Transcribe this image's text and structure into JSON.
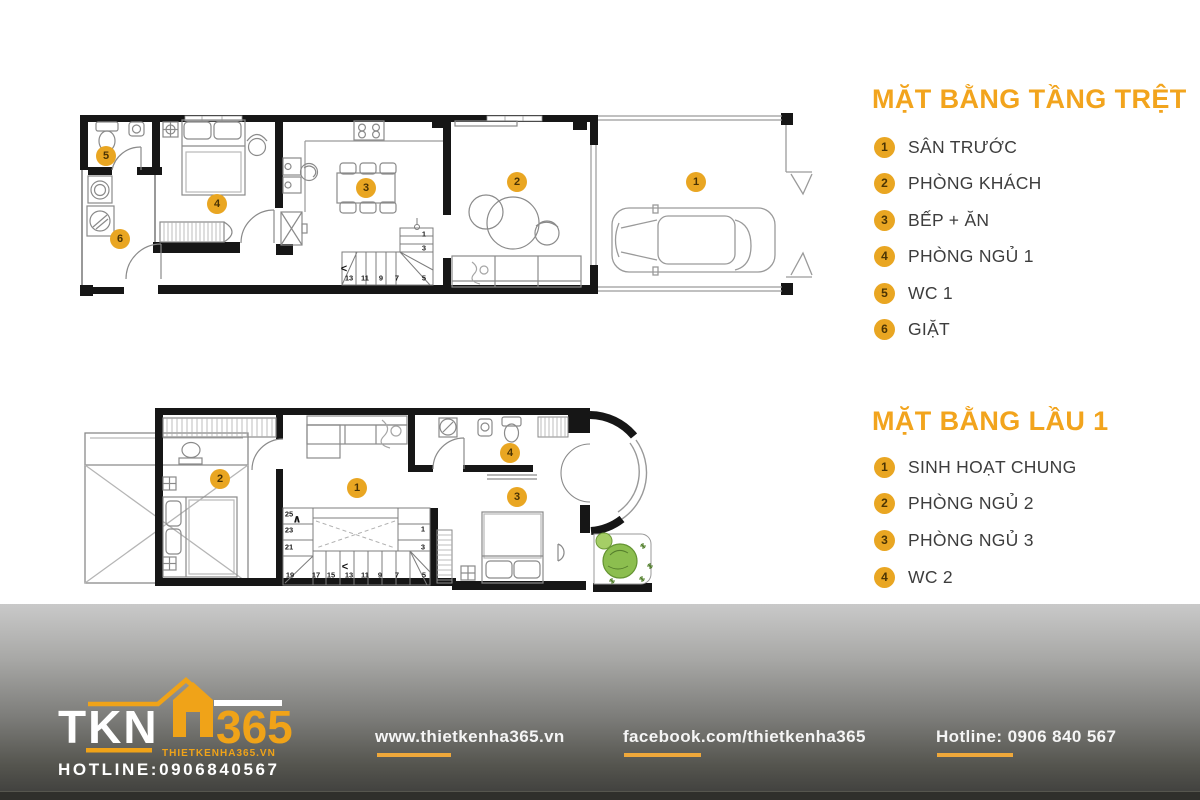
{
  "colors": {
    "accent": "#F0A41E",
    "marker_fill": "#E9A622",
    "legend_text": "#3D3D3D",
    "underline": "#EFA83A"
  },
  "ground_floor": {
    "title": "MẶT BẰNG TẦNG TRỆT",
    "items": [
      {
        "num": "1",
        "label": "SÂN TRƯỚC"
      },
      {
        "num": "2",
        "label": "PHÒNG KHÁCH"
      },
      {
        "num": "3",
        "label": "BẾP + ĂN"
      },
      {
        "num": "4",
        "label": "PHÒNG NGỦ 1"
      },
      {
        "num": "5",
        "label": "WC 1"
      },
      {
        "num": "6",
        "label": "GIẶT"
      }
    ],
    "markers": [
      {
        "n": "1",
        "x": 696,
        "y": 182
      },
      {
        "n": "2",
        "x": 517,
        "y": 182
      },
      {
        "n": "3",
        "x": 366,
        "y": 188
      },
      {
        "n": "4",
        "x": 217,
        "y": 204
      },
      {
        "n": "5",
        "x": 106,
        "y": 156
      },
      {
        "n": "6",
        "x": 120,
        "y": 239
      }
    ],
    "stair_labels": [
      {
        "t": "1",
        "x": 424,
        "y": 234
      },
      {
        "t": "3",
        "x": 424,
        "y": 248
      },
      {
        "t": "5",
        "x": 424,
        "y": 278
      },
      {
        "t": "7",
        "x": 397,
        "y": 278
      },
      {
        "t": "9",
        "x": 381,
        "y": 278
      },
      {
        "t": "11",
        "x": 365,
        "y": 278
      },
      {
        "t": "13",
        "x": 349,
        "y": 278
      }
    ],
    "stair_arrows": [
      {
        "t": "<",
        "x": 344,
        "y": 269
      }
    ]
  },
  "first_floor": {
    "title": "MẶT BẰNG LẦU 1",
    "items": [
      {
        "num": "1",
        "label": "SINH HOẠT CHUNG"
      },
      {
        "num": "2",
        "label": "PHÒNG NGỦ 2"
      },
      {
        "num": "3",
        "label": "PHÒNG NGỦ 3"
      },
      {
        "num": "4",
        "label": "WC 2"
      }
    ],
    "markers": [
      {
        "n": "1",
        "x": 357,
        "y": 488
      },
      {
        "n": "2",
        "x": 220,
        "y": 479
      },
      {
        "n": "3",
        "x": 517,
        "y": 497
      },
      {
        "n": "4",
        "x": 510,
        "y": 453
      }
    ],
    "stair_labels": [
      {
        "t": "25",
        "x": 289,
        "y": 514
      },
      {
        "t": "23",
        "x": 289,
        "y": 530
      },
      {
        "t": "21",
        "x": 289,
        "y": 547
      },
      {
        "t": "19",
        "x": 290,
        "y": 575
      },
      {
        "t": "17",
        "x": 316,
        "y": 575
      },
      {
        "t": "15",
        "x": 331,
        "y": 575
      },
      {
        "t": "13",
        "x": 349,
        "y": 575
      },
      {
        "t": "11",
        "x": 365,
        "y": 575
      },
      {
        "t": "9",
        "x": 380,
        "y": 575
      },
      {
        "t": "7",
        "x": 397,
        "y": 575
      },
      {
        "t": "5",
        "x": 424,
        "y": 575
      },
      {
        "t": "3",
        "x": 423,
        "y": 547
      },
      {
        "t": "1",
        "x": 423,
        "y": 529
      }
    ],
    "stair_arrows": [
      {
        "t": "∧",
        "x": 297,
        "y": 519
      },
      {
        "t": "<",
        "x": 345,
        "y": 567
      }
    ]
  },
  "footer": {
    "logo": {
      "tkn": "TKN",
      "num": "365",
      "site": "THIETKENHA365.VN",
      "hotline": "HOTLINE:0906840567"
    },
    "website": "www.thietkenha365.vn",
    "facebook": "facebook.com/thietkenha365",
    "hotline": "Hotline: 0906 840 567"
  }
}
